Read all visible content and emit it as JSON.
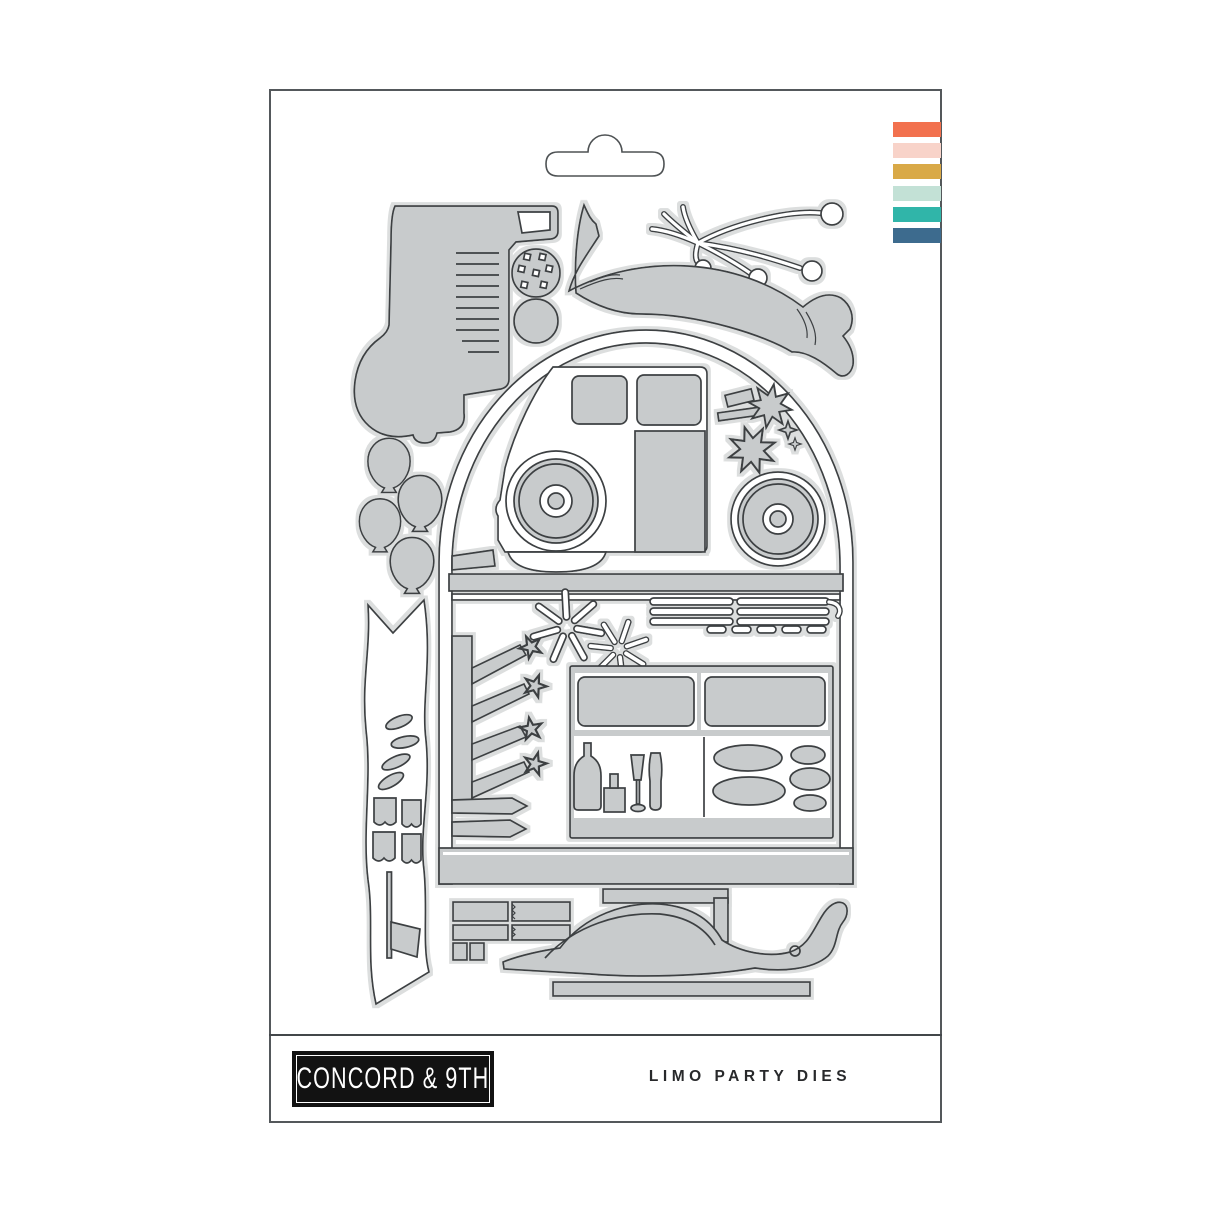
{
  "product": {
    "brand": "CONCORD & 9TH",
    "name": "LIMO PARTY DIES"
  },
  "package": {
    "card_color": "#ffffff",
    "border_color": "#54585b",
    "hang_tab": "euro-slot-hang-tab"
  },
  "palette": {
    "die_fill": "#c8cbcc",
    "die_outline": "#3c4043",
    "die_halo": "#dcdede",
    "logo_bg": "#121212",
    "logo_text": "#ffffff",
    "label_text": "#28292b"
  },
  "stripes": [
    {
      "name": "coral",
      "hex": "#F2714E"
    },
    {
      "name": "blush",
      "hex": "#F8D3C9"
    },
    {
      "name": "mustard",
      "hex": "#D9A947"
    },
    {
      "name": "mint",
      "hex": "#C3E1D6"
    },
    {
      "name": "teal",
      "hex": "#30B5A9"
    },
    {
      "name": "steel-blue",
      "hex": "#3D6B8E"
    }
  ],
  "dies": [
    "limo-front-panel",
    "disco-ball",
    "round-ornament",
    "curved-swoosh-banner",
    "party-streamers",
    "arch-frame",
    "limo-cab",
    "cab-windows",
    "front-wheel",
    "rear-wheel",
    "palm-confetti",
    "divider-trim",
    "raised-arms",
    "champagne-bottles",
    "starbursts",
    "trim-strips",
    "limo-body-window-box",
    "ice-bucket",
    "champagne-flutes",
    "stones",
    "ground-strip",
    "balloons-cluster",
    "vertical-pennant-banner",
    "confetti-bits",
    "flag",
    "bumper-strips",
    "rear-fender",
    "running-board"
  ]
}
